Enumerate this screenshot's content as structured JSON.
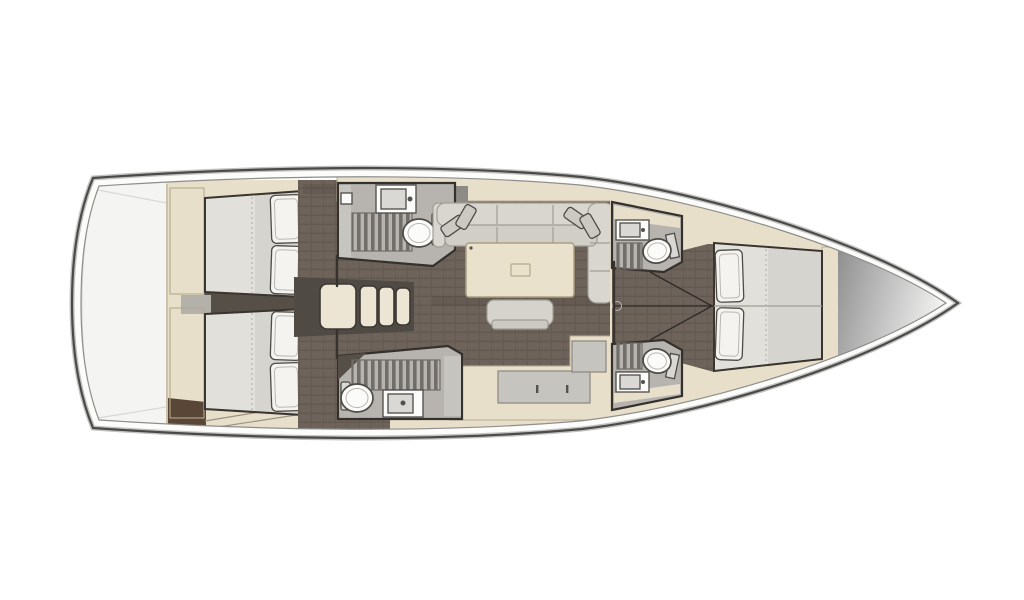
{
  "vessel": {
    "kind": "sailing-yacht-interior-floorplan",
    "view": "top-down rendered deck plan",
    "orientation": "bow-right-stern-left",
    "layout_summary": "3 double cabins, 4 heads, salon with U-sofa and table, L-galley, companionway with 4 steps"
  },
  "rooms": [
    {
      "id": "stern-deck",
      "name": "Stern / transom platform",
      "fixtures": []
    },
    {
      "id": "aft-cabin-port",
      "name": "Aft double cabin (port, top)",
      "fixtures": [
        "double berth",
        "2 pillows",
        "wardrobe"
      ]
    },
    {
      "id": "aft-cabin-starboard",
      "name": "Aft double cabin (starboard, bottom)",
      "fixtures": [
        "double berth",
        "2 pillows",
        "wardrobe"
      ]
    },
    {
      "id": "companionway",
      "name": "Companionway",
      "steps": 4
    },
    {
      "id": "aft-head-port",
      "name": "Aft head with shower (top)",
      "fixtures": [
        "sink",
        "shower grate",
        "toilet"
      ]
    },
    {
      "id": "salon",
      "name": "Salon",
      "fixtures": [
        "U-shaped sofa",
        "corner cushions",
        "saloon table",
        "bench seat"
      ]
    },
    {
      "id": "galley",
      "name": "L-shaped galley",
      "fixtures": [
        "worktop",
        "lockers"
      ]
    },
    {
      "id": "aft-head-starboard",
      "name": "Aft head with shower (bottom)",
      "fixtures": [
        "toilet",
        "sink",
        "shower grate"
      ]
    },
    {
      "id": "fwd-head-port",
      "name": "Forward head (top)",
      "fixtures": [
        "sink",
        "shower grate",
        "toilet"
      ]
    },
    {
      "id": "fwd-head-starboard",
      "name": "Forward head (bottom)",
      "fixtures": [
        "sink",
        "shower grate",
        "toilet"
      ]
    },
    {
      "id": "forward-cabin",
      "name": "Forward owner cabin",
      "fixtures": [
        "island double berth",
        "2 pillows",
        "lockers"
      ]
    },
    {
      "id": "bow",
      "name": "Bow / anchor locker",
      "fixtures": []
    }
  ],
  "colors": {
    "hull_fill": "#fcfcfb",
    "stern_deck": "#f4f4f2",
    "joinery": "#e8dfcb",
    "floor_wood": "#6e635a",
    "floor_wood_line": "#625950",
    "floor_dark": "#564f48",
    "landing_gray": "#b4b1ab",
    "steps_fill": "#ece5d3",
    "steps_surround": "#4f4a44",
    "mattress": "#e2e0da",
    "pillow": "#f4f3ef",
    "sofa": "#d9d6d0",
    "sofa_seat": "#d1cec7",
    "cushion": "#ccc9c2",
    "table": "#e9e1cc",
    "bench": "#d6d3cc",
    "bath_floor": "#b7b4af",
    "grate_slat": "#716e69",
    "counter_gray": "#c6c4bf",
    "fixture_white": "#fbfbfa",
    "fixture_inner": "#d9d8d5",
    "fixture_metal": "#55524d",
    "hatch_gray": "#8e8b86",
    "brown_wood": "#5a4636",
    "bow_cone_dark": "#8f8f8f",
    "bow_cone_light": "#f2f2f1",
    "dot_white": "#ffffff"
  }
}
